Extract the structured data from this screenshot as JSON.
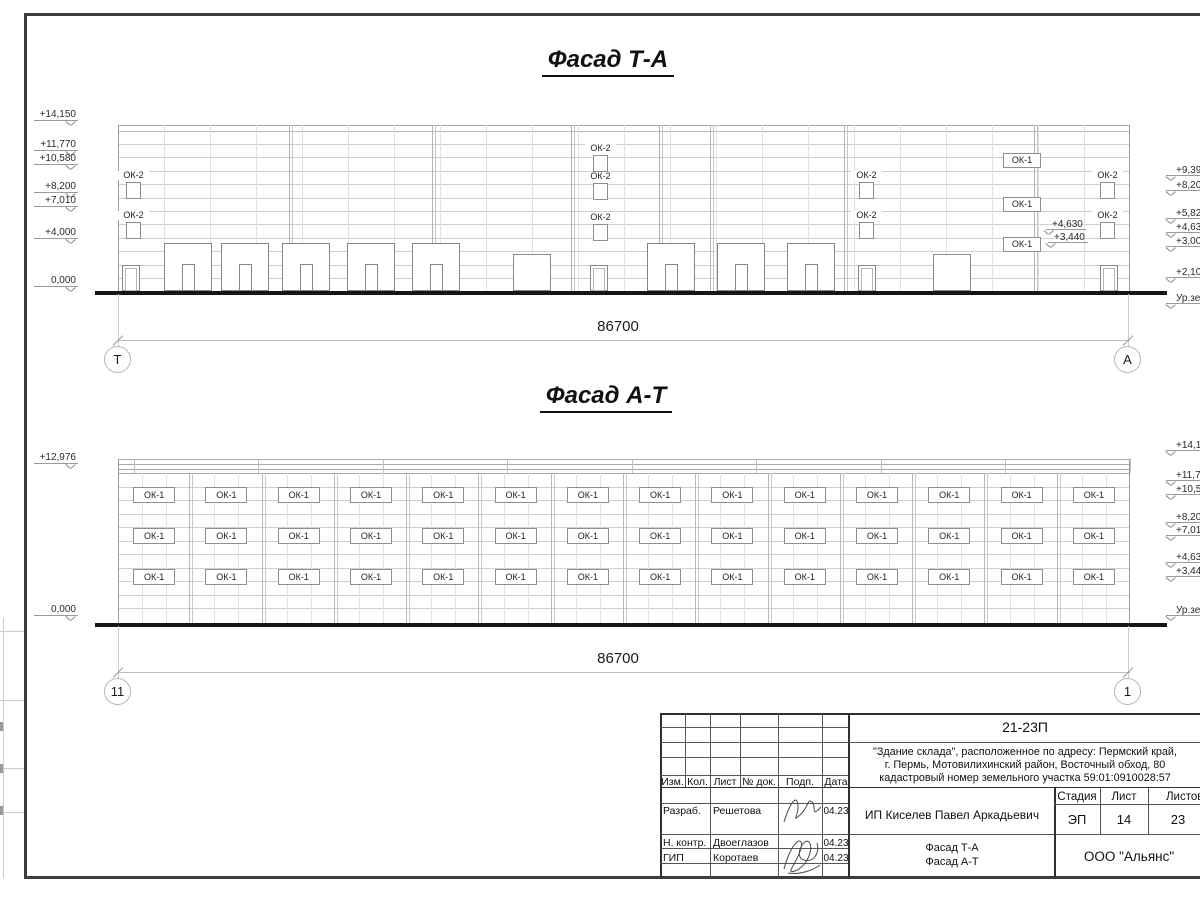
{
  "drawing": {
    "facade_top": {
      "title": "Фасад Т-А",
      "dimension": "86700",
      "axis_left": "Т",
      "axis_right": "А",
      "window_label_small": "ОК-2",
      "window_label_wide": "ОК-1",
      "left_marks": [
        {
          "t": "+14,150",
          "y": 110
        },
        {
          "t": "+11,770",
          "y": 140
        },
        {
          "t": "+10,580",
          "y": 154
        },
        {
          "t": "+8,200",
          "y": 182
        },
        {
          "t": "+7,010",
          "y": 196
        },
        {
          "t": "+4,000",
          "y": 228
        },
        {
          "t": "0,000",
          "y": 276
        }
      ],
      "right_marks": [
        {
          "t": "+9,39",
          "y": 166
        },
        {
          "t": "+8,20",
          "y": 181
        },
        {
          "t": "+5,82",
          "y": 209
        },
        {
          "t": "+4,63",
          "y": 223
        },
        {
          "t": "+3,00",
          "y": 237
        },
        {
          "t": "+2,10",
          "y": 268
        },
        {
          "t": "Ур.зе",
          "y": 294
        }
      ],
      "inner_marks": [
        {
          "t": "+4,630",
          "x": 1052,
          "y": 220
        },
        {
          "t": "+3,440",
          "x": 1054,
          "y": 233
        }
      ],
      "ok2_stacks": [
        {
          "x": 126,
          "rows": [
            182,
            222
          ]
        },
        {
          "x": 593,
          "rows": [
            155,
            183,
            224
          ]
        },
        {
          "x": 859,
          "rows": [
            182,
            222
          ]
        },
        {
          "x": 1100,
          "rows": [
            182,
            222
          ]
        }
      ],
      "ok1_column": {
        "x": 1003,
        "w": 38,
        "h": 15,
        "rows": [
          153,
          197,
          237
        ]
      },
      "doors_single": [
        122,
        590,
        858,
        1100
      ],
      "doors_double": [
        513,
        933
      ],
      "doors_sectional": [
        164,
        221,
        282,
        347,
        412,
        647,
        717,
        787
      ]
    },
    "facade_bottom": {
      "title": "Фасад А-Т",
      "dimension": "86700",
      "axis_left": "11",
      "axis_right": "1",
      "window_label": "ОК-1",
      "left_marks": [
        {
          "t": "+12,976",
          "y": 453
        },
        {
          "t": "0,000",
          "y": 605
        }
      ],
      "right_marks": [
        {
          "t": "+14,15",
          "y": 441
        },
        {
          "t": "+11,77",
          "y": 471
        },
        {
          "t": "+10,58",
          "y": 485
        },
        {
          "t": "+8,20",
          "y": 513
        },
        {
          "t": "+7,01",
          "y": 526
        },
        {
          "t": "+4,63",
          "y": 553
        },
        {
          "t": "+3,44",
          "y": 567
        },
        {
          "t": "Ур.зем",
          "y": 606
        }
      ],
      "window_rows": [
        487,
        528,
        569
      ],
      "window_cols": 14
    }
  },
  "titleblock": {
    "code": "21-23П",
    "description": [
      "\"Здание склада\", расположенное по адресу: Пермский край,",
      "г. Пермь, Мотовилихинский район, Восточный обход, 80",
      "кадастровый номер земельного участка 59:01:0910028:57"
    ],
    "columns": {
      "izm": "Изм.",
      "kol": "Кол.",
      "list": "Лист",
      "doc": "№ док.",
      "podp": "Подп.",
      "data": "Дата"
    },
    "rows": [
      {
        "role": "Разраб.",
        "name": "Решетова",
        "date": "04.23"
      },
      {
        "role": "Н. контр.",
        "name": "Двоеглазов",
        "date": "04.23"
      },
      {
        "role": "ГИП",
        "name": "Коротаев",
        "date": "04.23"
      }
    ],
    "client": "ИП Киселев Павел Аркадьевич",
    "stage": {
      "label": "Стадия",
      "value": "ЭП"
    },
    "sheet": {
      "label": "Лист",
      "value": "14"
    },
    "sheets_total": {
      "label": "Листов",
      "value": "23"
    },
    "doc_title": [
      "Фасад Т-А",
      "Фасад А-Т"
    ],
    "company": "ООО \"Альянс\""
  }
}
